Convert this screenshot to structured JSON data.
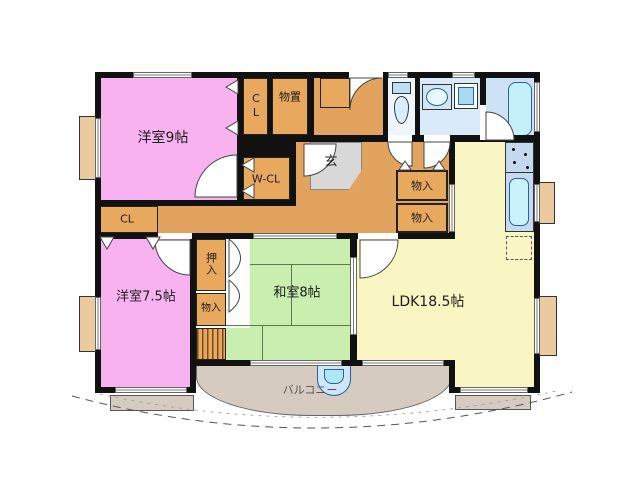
{
  "plan": {
    "rooms": {
      "western9": {
        "label": "洋室9帖",
        "color": "#f7b2ef"
      },
      "western75": {
        "label": "洋室7.5帖",
        "color": "#f7b2ef"
      },
      "japanese8": {
        "label": "和室8帖",
        "color": "#c8efb0"
      },
      "ldk": {
        "label": "LDK18.5帖",
        "color": "#f9f6c3"
      },
      "entrance": {
        "label": "玄",
        "color": "#d8d8d8"
      },
      "balcony": {
        "label": "バルコニー",
        "color": "#d6cbc0"
      },
      "hall": {
        "color": "#e2a35f"
      },
      "washroom": {
        "color": "#d9eafa"
      },
      "bathroom": {
        "color": "#cde3f5"
      },
      "toilet": {
        "color": "#eef5fc"
      },
      "kitchen_counter": {
        "color": "#c5daf1"
      }
    },
    "storage": {
      "closet_top": "CL",
      "storeroom": "物置",
      "walk_in_closet": "W-CL",
      "closet_left": "CL",
      "oshiire": "押入",
      "monoire_column": "物入",
      "monoire_hall_upper": "物入",
      "monoire_hall_lower": "物入"
    },
    "fixtures": [
      "toilet",
      "vanity-sink",
      "washing-machine",
      "bathtub",
      "kitchen-stove",
      "kitchen-sink",
      "refrigerator-space",
      "balcony-sink",
      "staircase"
    ]
  }
}
